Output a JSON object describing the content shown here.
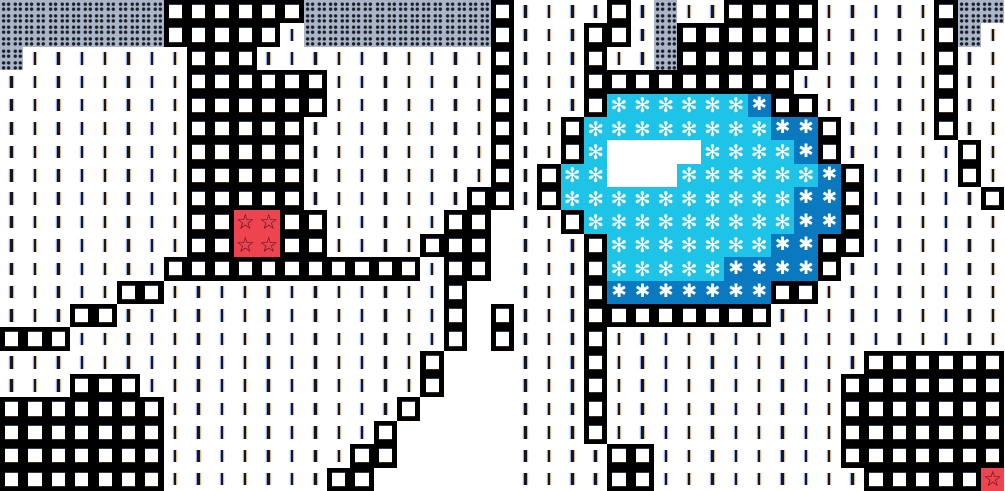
{
  "canvas": {
    "width": 1005,
    "height": 491
  },
  "map": {
    "description": "top-down tile map viewport",
    "colors": {
      "background": "#ffffff",
      "gravel": "#a9b6c9",
      "gravel_dots": "#1c1c22",
      "wall": "#000000",
      "wall_center": "#ffffff",
      "field_dash": "#16161f",
      "water": "#1ec3e8",
      "deep_water": "#0b79c0",
      "marker_red": "#ee4450",
      "marker_star_stroke": "#47121c",
      "glyph_white": "#ffffff"
    }
  },
  "tilemap": {
    "cols": 43,
    "rows": 21,
    "tile_width": 23.372,
    "tile_height": 23.381,
    "legend": {
      ":": {
        "type": "gravel",
        "name": "gravel-tile",
        "icon": "four-dots-icon",
        "glyph_char": ""
      },
      ".": {
        "type": "field",
        "name": "field-tile",
        "icon": "vertical-dash-icon",
        "glyph_char": ""
      },
      "#": {
        "type": "wall",
        "name": "wall-tile",
        "icon": "block-center-icon",
        "glyph_char": ""
      },
      "w": {
        "type": "water",
        "name": "water-lily-tile",
        "icon": "flower-icon",
        "glyph_char": "✻"
      },
      "W": {
        "type": "deep",
        "name": "deep-water-tile",
        "icon": "heavy-asterisk-icon",
        "glyph_char": "✱"
      },
      "r": {
        "type": "marker",
        "name": "star-marker-tile",
        "icon": "star-outline-icon",
        "glyph_char": "☆"
      },
      "_": {
        "type": "floor",
        "name": "floor-tile",
        "icon": "",
        "glyph_char": ""
      }
    },
    "rows_data": [
      ":::::::######::::::::#....#.:..####.....#::",
      ":::::::#####.::::::::#...##.:######.....#:.",
      ":.......###..........#...#..:######.....#..",
      "........######.......#...#########......#..",
      "........######.......#...#wwwwwwW##.....#..",
      "........#####........#..#wwwwwwwwWW#....#..",
      "........#####........#..#w____wwwwW#.....#.",
      "........#####........#.#ww___wwwwwwW#....#.",
      "........#####.......##.#wwwwwwwwwwWW#.....#",
      "........##rr##.....##_..#wwwwwwwwwWW#......",
      "........##rr##....###_...#wwwwwwwWW##......",
      ".......###########.##_...#wwwwwWWWW#.......",
      ".....##............#__...#WWWWWWW##........",
      "...##..............#_#...########..........",
      "###................#_#...#.................",
      "..................#___...#...........######",
      "...###............#___...#..........#######",
      "#######..........#____...#..........#######",
      "#######.........#_____...#..........#######",
      "#######........##_____....##........#######",
      "#######.......##______....##.........#####r"
    ]
  }
}
